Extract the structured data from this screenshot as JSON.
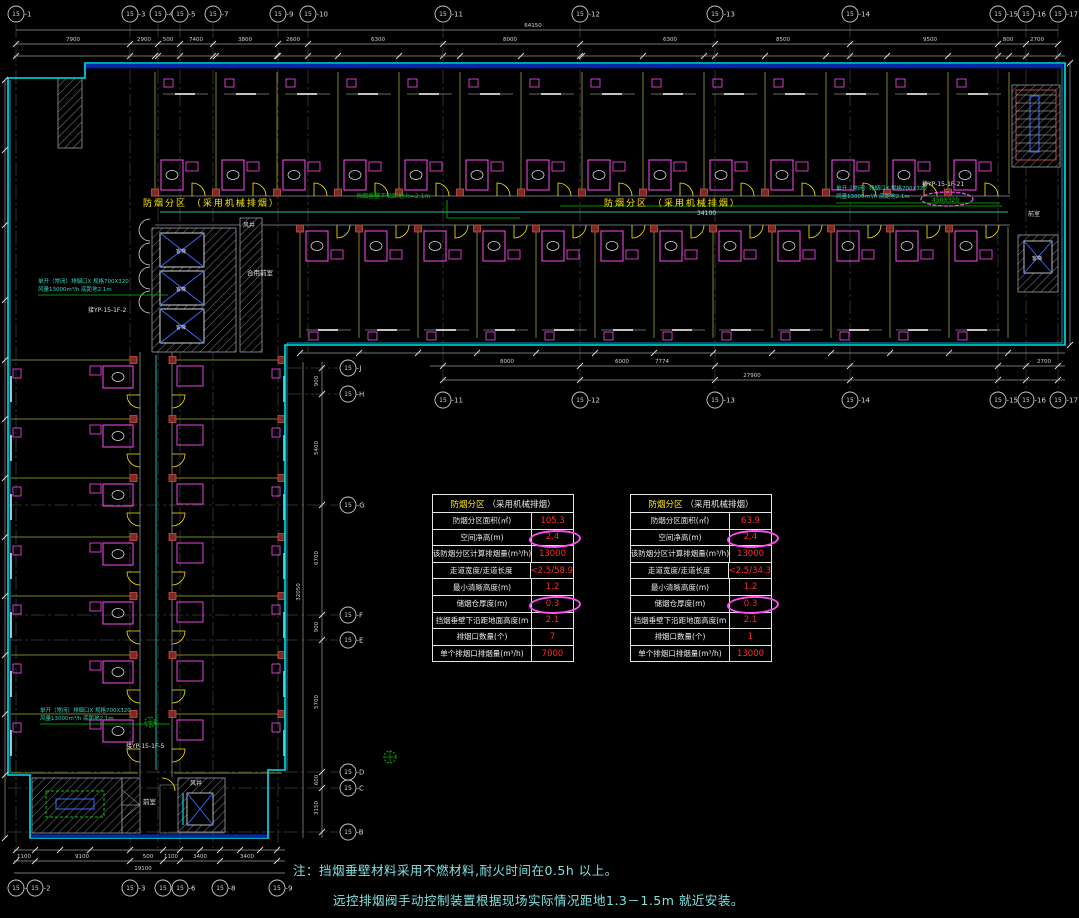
{
  "colors": {
    "wall": "#00e0f0",
    "wall_band": "#0028b8",
    "partition": "#7f7f2a",
    "door": "#ffe800",
    "fixture": "#ff4df0",
    "column_fill": "#7e2a22",
    "column_stroke": "#c8524a",
    "hatch": "#98a0a8",
    "grid": "#2e2e2e",
    "dim_line": "#9a9a9a",
    "dim_text": "#d0d0d0",
    "bubble": "#c8c8c8",
    "label_yellow": "#ffe800",
    "value_red": "#ff2a2a",
    "cloud": "#ff4df0",
    "note": "#7fe0e0",
    "annotation": "#2fd8c0",
    "green": "#00c400",
    "blue": "#3a6bff",
    "white": "#e0e0e0",
    "teal": "#18b8a8",
    "corridor_wall": "#8a94a0"
  },
  "grid": {
    "top": {
      "y": 14,
      "bubbles": [
        {
          "label": "15-1",
          "x": 16
        },
        {
          "label": "15-3",
          "x": 130
        },
        {
          "label": "15-4",
          "x": 158
        },
        {
          "label": "15-5",
          "x": 180
        },
        {
          "label": "15-7",
          "x": 213
        },
        {
          "label": "15-9",
          "x": 278
        },
        {
          "label": "15-10",
          "x": 308
        },
        {
          "label": "15-11",
          "x": 443
        },
        {
          "label": "15-12",
          "x": 580
        },
        {
          "label": "15-13",
          "x": 715
        },
        {
          "label": "15-14",
          "x": 850
        },
        {
          "label": "15-15",
          "x": 998
        },
        {
          "label": "15-16",
          "x": 1026
        },
        {
          "label": "15-17",
          "x": 1058
        }
      ]
    },
    "mid": {
      "y": 400,
      "bubbles": [
        {
          "label": "15-11",
          "x": 443
        },
        {
          "label": "15-12",
          "x": 580
        },
        {
          "label": "15-13",
          "x": 715
        },
        {
          "label": "15-14",
          "x": 850
        },
        {
          "label": "15-15",
          "x": 998
        },
        {
          "label": "15-16",
          "x": 1026
        },
        {
          "label": "15-17",
          "x": 1058
        }
      ]
    },
    "bottom": {
      "y": 888,
      "bubbles": [
        {
          "label": "15-1",
          "x": 16
        },
        {
          "label": "15-2",
          "x": 35
        },
        {
          "label": "15-3",
          "x": 130
        },
        {
          "label": "15-5",
          "x": 163
        },
        {
          "label": "15-6",
          "x": 180
        },
        {
          "label": "15-8",
          "x": 220
        },
        {
          "label": "15-9",
          "x": 277
        }
      ]
    },
    "right": {
      "x": 348,
      "bubbles": [
        {
          "label": "15-J",
          "y": 368
        },
        {
          "label": "15-H",
          "y": 394
        },
        {
          "label": "15-G",
          "y": 505
        },
        {
          "label": "15-F",
          "y": 615
        },
        {
          "label": "15-E",
          "y": 640
        },
        {
          "label": "15-D",
          "y": 772
        },
        {
          "label": "15-C",
          "y": 788
        },
        {
          "label": "15-B",
          "y": 832
        }
      ]
    }
  },
  "dimensions": {
    "top": {
      "overall": "64150",
      "overall_x": 533,
      "segments": [
        {
          "t": "7900",
          "x": 73
        },
        {
          "t": "2900",
          "x": 144
        },
        {
          "t": "500",
          "x": 168
        },
        {
          "t": "7400",
          "x": 196
        },
        {
          "t": "3800",
          "x": 245
        },
        {
          "t": "2600",
          "x": 293
        },
        {
          "t": "6300",
          "x": 378
        },
        {
          "t": "8000",
          "x": 510
        },
        {
          "t": "6300",
          "x": 670
        },
        {
          "t": "8500",
          "x": 783
        },
        {
          "t": "9500",
          "x": 930
        },
        {
          "t": "800",
          "x": 1008
        },
        {
          "t": "2700",
          "x": 1037
        }
      ]
    },
    "mid": {
      "overall": "27900",
      "overall_x": 752,
      "segments": [
        {
          "t": "8000",
          "x": 507
        },
        {
          "t": "6000",
          "x": 622
        },
        {
          "t": "7774",
          "x": 662
        },
        {
          "t": "2700",
          "x": 1044
        }
      ]
    },
    "bottom": {
      "overall": "19100",
      "overall_x": 143,
      "segments": [
        {
          "t": "1100",
          "x": 24
        },
        {
          "t": "9100",
          "x": 82
        },
        {
          "t": "500",
          "x": 148
        },
        {
          "t": "1100",
          "x": 171
        },
        {
          "t": "3400",
          "x": 200
        },
        {
          "t": "3400",
          "x": 247
        }
      ]
    },
    "right": {
      "overall": "32050",
      "overall_y": 592,
      "segments": [
        {
          "t": "900",
          "y": 381
        },
        {
          "t": "5400",
          "y": 448
        },
        {
          "t": "6700",
          "y": 558
        },
        {
          "t": "900",
          "y": 627
        },
        {
          "t": "5700",
          "y": 702
        },
        {
          "t": "600",
          "y": 780
        },
        {
          "t": "3150",
          "y": 808
        }
      ]
    }
  },
  "corridor_labels": [
    {
      "text": "防烟分区 （采用机械排烟）",
      "x": 143,
      "y": 206
    },
    {
      "text": "防烟分区 （采用机械排烟）",
      "x": 604,
      "y": 206
    }
  ],
  "plan_texts": [
    {
      "text": "34100",
      "x": 697,
      "y": 215,
      "color": "white",
      "size": 6
    },
    {
      "text": "挡烟垂壁下沿距地:h=2.1m",
      "x": 356,
      "y": 198,
      "color": "green",
      "size": 6
    },
    {
      "text": "单开（常闭）排烟口X 规格700X320",
      "x": 38,
      "y": 283,
      "color": "annotation",
      "size": 5.5
    },
    {
      "text": "风量13000m³/h 底距地2.1m",
      "x": 38,
      "y": 291,
      "color": "annotation",
      "size": 5.5
    },
    {
      "text": "接YP-15-1F-2",
      "x": 88,
      "y": 312,
      "color": "white",
      "size": 6
    },
    {
      "text": "单开（常闭）排烟口X 规格700X320",
      "x": 40,
      "y": 712,
      "color": "annotation",
      "size": 5.5
    },
    {
      "text": "风量13000m³/h 底距地2.1m",
      "x": 40,
      "y": 720,
      "color": "annotation",
      "size": 5.5
    },
    {
      "text": "接YP-15-1F-5",
      "x": 126,
      "y": 748,
      "color": "white",
      "size": 6
    },
    {
      "text": "单开（常闭）排烟口X 规格700X320",
      "x": 836,
      "y": 190,
      "color": "annotation",
      "size": 5.5
    },
    {
      "text": "风量13000m³/h 底距地2.1m",
      "x": 836,
      "y": 198,
      "color": "annotation",
      "size": 5.5
    },
    {
      "text": "接YP-15-1F-21",
      "x": 922,
      "y": 186,
      "color": "white",
      "size": 6
    },
    {
      "text": "450X320",
      "x": 932,
      "y": 202,
      "color": "green",
      "size": 6,
      "cloud": true
    },
    {
      "text": "合用前室",
      "x": 247,
      "y": 275,
      "color": "white",
      "size": 6.5
    },
    {
      "text": "风井",
      "x": 243,
      "y": 227,
      "color": "white",
      "size": 6
    },
    {
      "text": "前室",
      "x": 143,
      "y": 804,
      "color": "white",
      "size": 6.5
    },
    {
      "text": "风井",
      "x": 190,
      "y": 785,
      "color": "white",
      "size": 6
    },
    {
      "text": "前室",
      "x": 1028,
      "y": 216,
      "color": "white",
      "size": 6
    },
    {
      "text": "客梯",
      "x": 176,
      "y": 253,
      "color": "white",
      "size": 5
    },
    {
      "text": "客梯",
      "x": 176,
      "y": 291,
      "color": "white",
      "size": 5
    },
    {
      "text": "客梯",
      "x": 176,
      "y": 329,
      "color": "white",
      "size": 5
    },
    {
      "text": "客梯",
      "x": 1032,
      "y": 260,
      "color": "white",
      "size": 5
    }
  ],
  "tables": {
    "title_strong": "防烟分区",
    "title_rest": "（采用机械排烟）",
    "row_labels": [
      "防烟分区面积(㎡)",
      "空间净高(m)",
      "该防烟分区计算排烟量(m³/h)",
      "走道宽度/走道长度",
      "最小清晰高度(m)",
      "储烟仓厚度(m)",
      "挡烟垂壁下沿距地面高度(m",
      "排烟口数量(个)",
      "单个排烟口排烟量(m³/h)"
    ],
    "circled_rows": [
      1,
      5
    ],
    "values": [
      [
        "105.3",
        "2.4",
        "13000",
        "<2.5/58.9",
        "1.2",
        "0.3",
        "2.1",
        "7",
        "7000"
      ],
      [
        "63.9",
        "2.4",
        "13000",
        "<2.5/34.3",
        "1.2",
        "0.3",
        "2.1",
        "1",
        "13000"
      ]
    ]
  },
  "notes": [
    "注：挡烟垂壁材料采用不燃材料,耐火时间在0.5h 以上。",
    "远控排烟阀手动控制装置根据现场实际情况距地1.3－1.5m 就近安装。"
  ]
}
